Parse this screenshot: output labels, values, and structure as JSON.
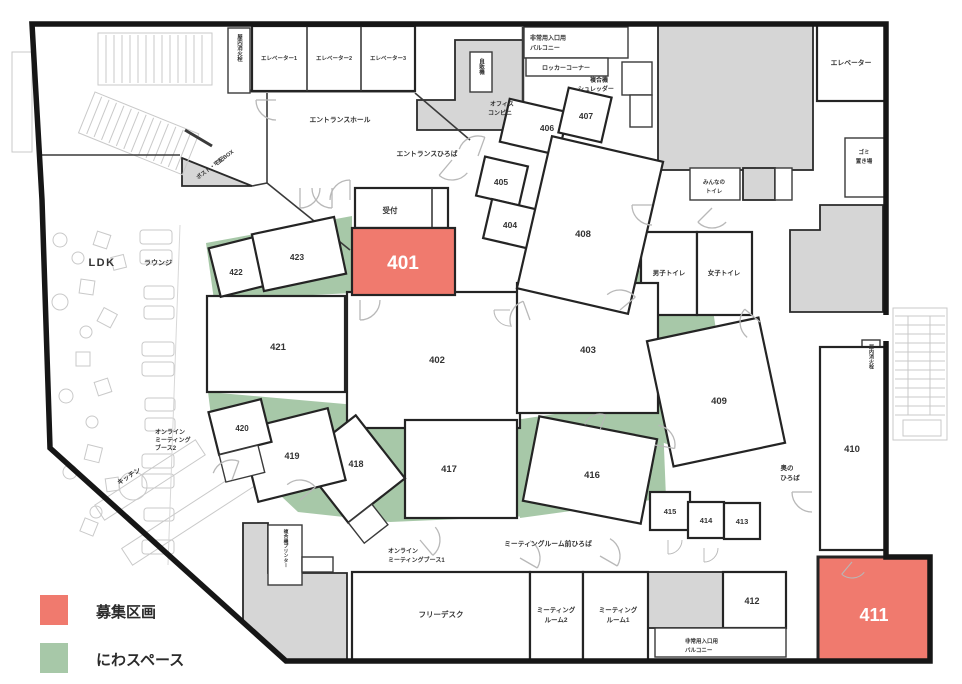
{
  "legend": {
    "items": [
      {
        "label": "募集区画",
        "color": "#f07a6e"
      },
      {
        "label": "にわスペース",
        "color": "#a7c8a8"
      }
    ]
  },
  "available_rooms": [
    "401",
    "411"
  ],
  "colors": {
    "available": "#f07a6e",
    "niwa_space": "#a7c8a8",
    "service_gray": "#d6d6d6",
    "wall": "#161616"
  },
  "rooms": {
    "r401": {
      "label": "401",
      "status": "募集区画"
    },
    "r402": {
      "label": "402"
    },
    "r403": {
      "label": "403"
    },
    "r404": {
      "label": "404"
    },
    "r405": {
      "label": "405"
    },
    "r406": {
      "label": "406"
    },
    "r407": {
      "label": "407"
    },
    "r408": {
      "label": "408"
    },
    "r409": {
      "label": "409"
    },
    "r410": {
      "label": "410"
    },
    "r411": {
      "label": "411",
      "status": "募集区画"
    },
    "r412": {
      "label": "412"
    },
    "r413": {
      "label": "413"
    },
    "r414": {
      "label": "414"
    },
    "r415": {
      "label": "415"
    },
    "r416": {
      "label": "416"
    },
    "r417": {
      "label": "417"
    },
    "r418": {
      "label": "418"
    },
    "r419": {
      "label": "419"
    },
    "r420": {
      "label": "420"
    },
    "r421": {
      "label": "421"
    },
    "r422": {
      "label": "422"
    },
    "r423": {
      "label": "423"
    }
  },
  "areas": {
    "ldk": "LDK",
    "lounge": "ラウンジ",
    "kitchen": "キッチン",
    "entrance_hall": "エントランスホール",
    "entrance_plaza": "エントランスひろば",
    "reception": "受付",
    "post_box": "ポスト・宅配BOX",
    "ev1": "エレベーター1",
    "ev2": "エレベーター2",
    "ev3": "エレベーター3",
    "ev_right": "エレベーター",
    "hydrant_left": "屋内消火栓",
    "hydrant_right": "屋内消火栓",
    "vending": "自販機",
    "balcony_top_l1": "非常用入口用",
    "balcony_top_l2": "バルコニー",
    "locker": "ロッカーコーナー",
    "copier_l1": "複合機",
    "copier_l2": "シュレッダー",
    "office_l1": "オフィス",
    "office_l2": "コンビニ",
    "everyone_toilet_l1": "みんなの",
    "everyone_toilet_l2": "トイレ",
    "garbage_l1": "ゴミ",
    "garbage_l2": "置き場",
    "mens_toilet": "男子トイレ",
    "womens_toilet": "女子トイレ",
    "back_plaza_l1": "奥の",
    "back_plaza_l2": "ひろば",
    "meeting_plaza": "ミーティングルーム前ひろば",
    "online1_l1": "オンライン",
    "online1_l2": "ミーティングブース1",
    "online2_l1": "オンライン",
    "online2_l2": "ミーティング",
    "online2_l3": "ブース2",
    "free_desk": "フリーデスク",
    "meeting_room1_l1": "ミーティング",
    "meeting_room1_l2": "ルーム1",
    "meeting_room2_l1": "ミーティング",
    "meeting_room2_l2": "ルーム2",
    "balcony_bottom_l1": "非常用入口用",
    "balcony_bottom_l2": "バルコニー",
    "printer_room": "複合機プリンター"
  }
}
